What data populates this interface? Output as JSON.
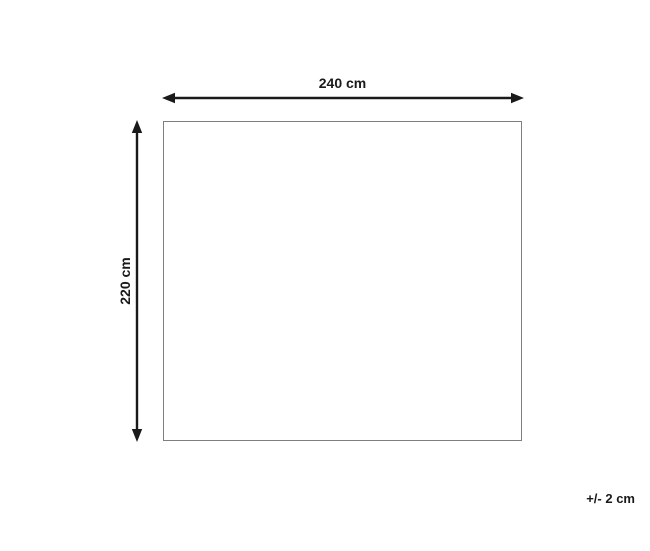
{
  "diagram": {
    "width_label": "240 cm",
    "height_label": "220 cm",
    "tolerance_label": "+/- 2 cm",
    "colors": {
      "background": "#ffffff",
      "arrow": "#1a1a1a",
      "rect_border": "#7f7f7f",
      "text": "#1a1a1a"
    }
  }
}
